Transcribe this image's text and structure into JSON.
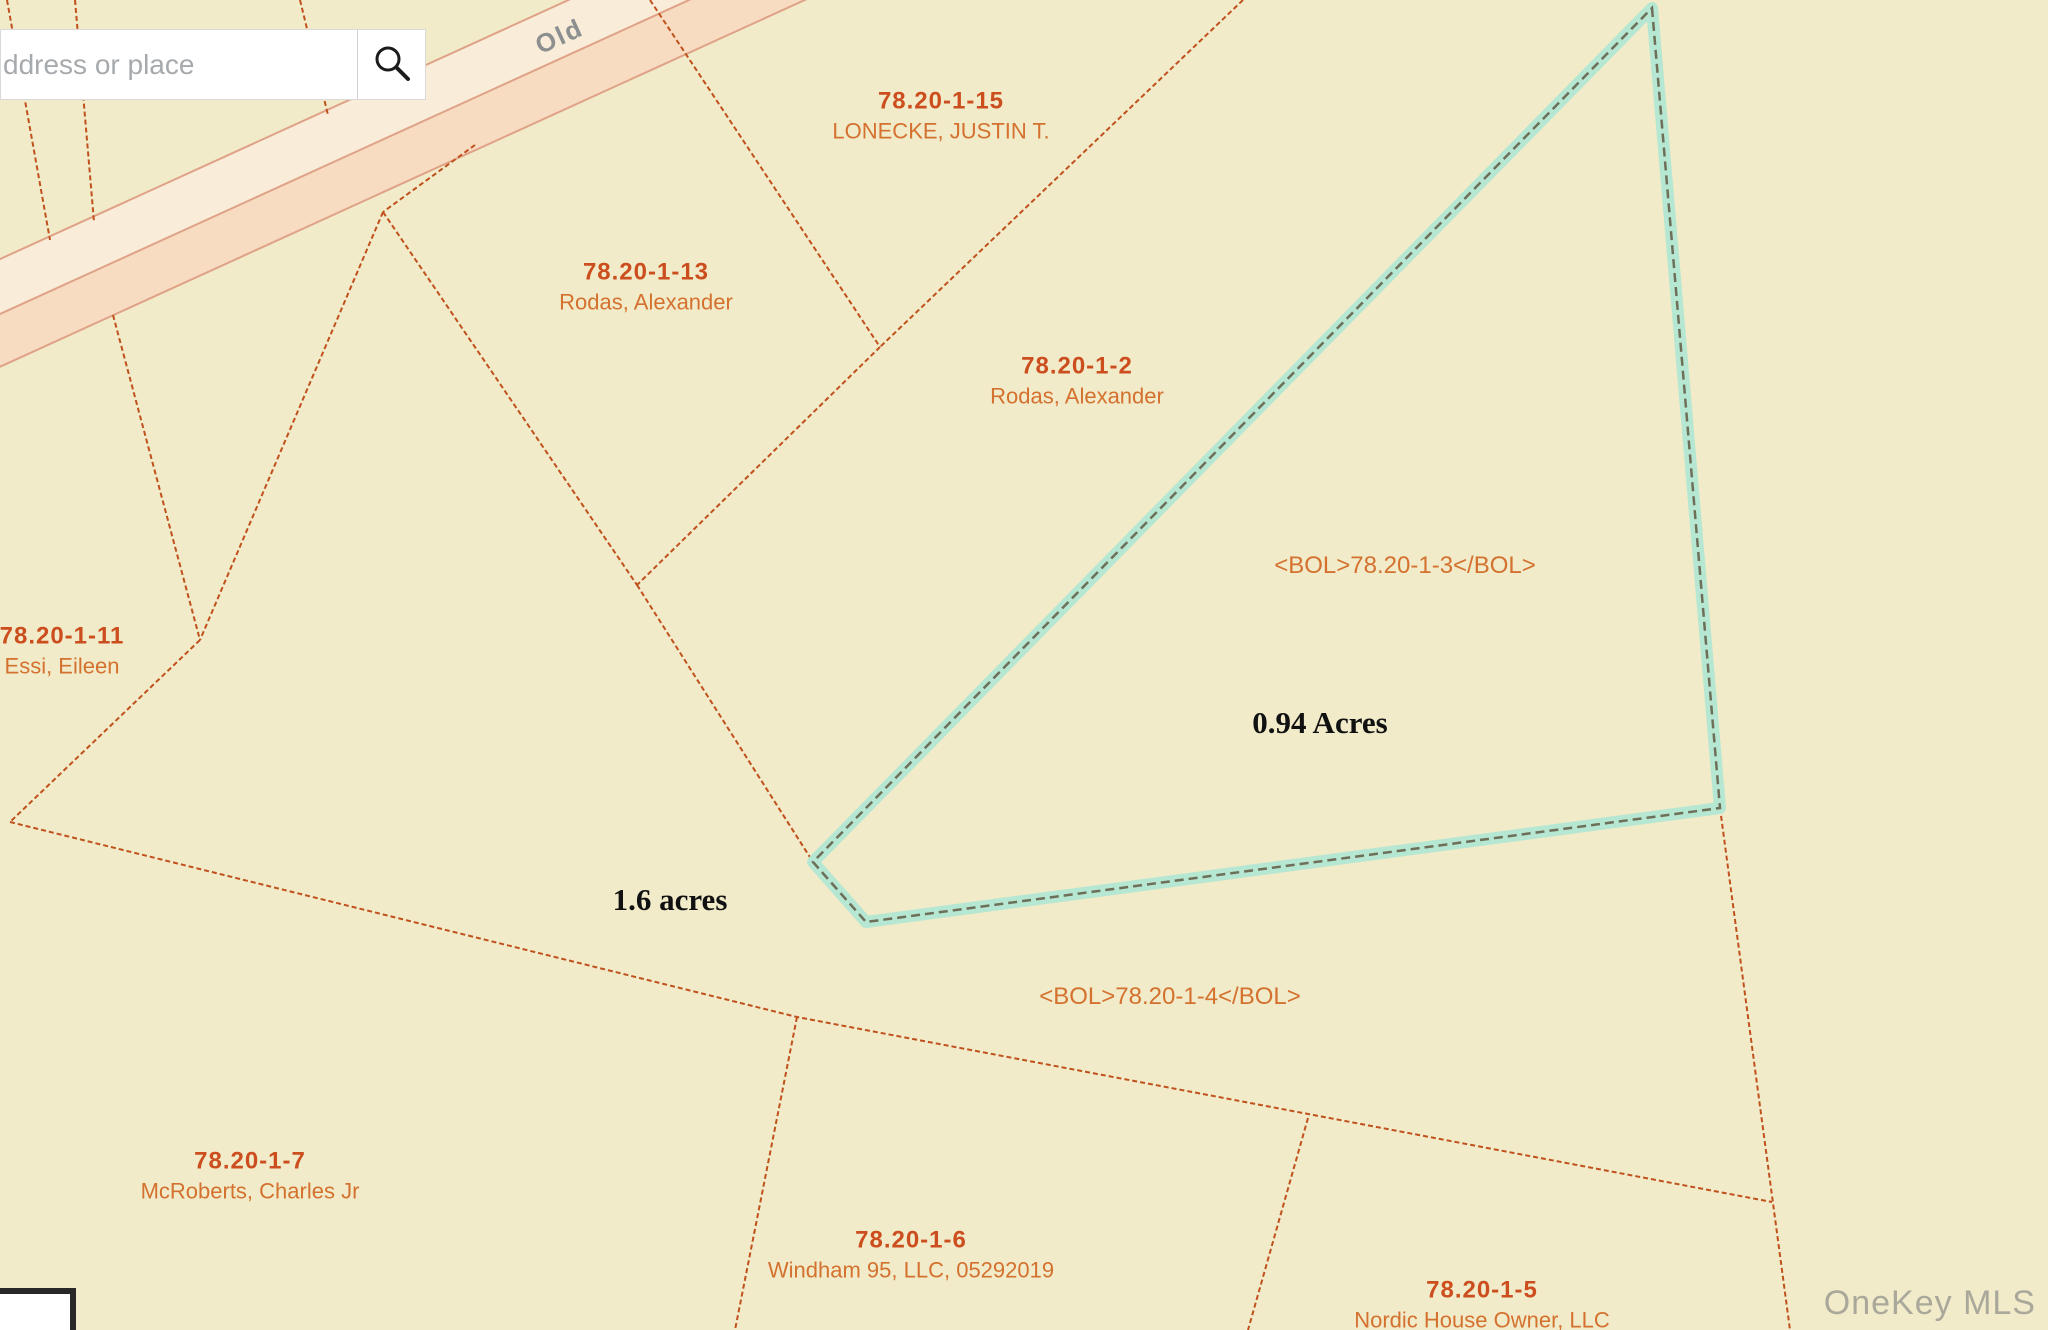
{
  "header": {
    "search": {
      "placeholder": "ddress or place",
      "icon": "magnifier"
    }
  },
  "map": {
    "background_color": "#f1ebc9",
    "boundary_line_color": "#c0511d",
    "road": {
      "label": "Old",
      "label_color": "#8c8f90",
      "angle_deg": -24.5,
      "origin": [
        0,
        325
      ],
      "strips": [
        {
          "v": -60,
          "h": 50,
          "color": "#f9ecd8"
        },
        {
          "v": -10,
          "h": 48,
          "color": "#f7dcc1"
        }
      ],
      "edge_v": [
        -60,
        -10,
        38
      ],
      "edge_color": "#dfa287",
      "label_pos": [
        604,
        -22
      ]
    },
    "boundary_lines": [
      [
        [
          7,
          0
        ],
        [
          50,
          240
        ]
      ],
      [
        [
          75,
          0
        ],
        [
          94,
          222
        ]
      ],
      [
        [
          300,
          0
        ],
        [
          328,
          115
        ]
      ],
      [
        [
          650,
          0
        ],
        [
          880,
          347
        ]
      ],
      [
        [
          1243,
          0
        ],
        [
          880,
          347
        ]
      ],
      [
        [
          880,
          347
        ],
        [
          637,
          585
        ]
      ],
      [
        [
          475,
          145
        ],
        [
          383,
          212
        ]
      ],
      [
        [
          383,
          212
        ],
        [
          637,
          585
        ]
      ],
      [
        [
          637,
          585
        ],
        [
          813,
          862
        ]
      ],
      [
        [
          383,
          212
        ],
        [
          200,
          640
        ]
      ],
      [
        [
          113,
          315
        ],
        [
          200,
          640
        ]
      ],
      [
        [
          200,
          640
        ],
        [
          10,
          822
        ]
      ],
      [
        [
          10,
          822
        ],
        [
          797,
          1017
        ],
        [
          1772,
          1202
        ]
      ],
      [
        [
          797,
          1017
        ],
        [
          735,
          1330
        ]
      ],
      [
        [
          1308,
          1118
        ],
        [
          1248,
          1330
        ]
      ],
      [
        [
          1720,
          808
        ],
        [
          1790,
          1330
        ]
      ]
    ],
    "highlighted_parcel": {
      "points": [
        [
          1652,
          8
        ],
        [
          1720,
          808
        ],
        [
          866,
          922
        ],
        [
          813,
          862
        ]
      ],
      "halo_color": "#b5e7d3",
      "line_color": "#6e6f58",
      "label": "<BOL>78.20-1-3</BOL>",
      "area": "0.94 Acres"
    },
    "parcel_labels": [
      {
        "id": "78.20-1-15",
        "owner": "LONECKE, JUSTIN T.",
        "x": 941,
        "y": 100
      },
      {
        "id": "78.20-1-13",
        "owner": "Rodas, Alexander",
        "x": 646,
        "y": 271
      },
      {
        "id": "78.20-1-2",
        "owner": "Rodas, Alexander",
        "x": 1077,
        "y": 365
      },
      {
        "id": "78.20-1-11",
        "owner": "Essi, Eileen",
        "x": 62,
        "y": 635
      },
      {
        "id": "78.20-1-7",
        "owner": "McRoberts, Charles Jr",
        "x": 250,
        "y": 1160
      },
      {
        "id": "78.20-1-6",
        "owner": "Windham 95, LLC, 05292019",
        "x": 911,
        "y": 1239
      },
      {
        "id": "78.20-1-5",
        "owner": "Nordic House Owner, LLC",
        "x": 1482,
        "y": 1289
      }
    ],
    "tag_labels": [
      {
        "text": "<BOL>78.20-1-3</BOL>",
        "x": 1405,
        "y": 566
      },
      {
        "text": "<BOL>78.20-1-4</BOL>",
        "x": 1170,
        "y": 997
      }
    ],
    "area_labels": [
      {
        "text": "0.94 Acres",
        "x": 1320,
        "y": 723
      },
      {
        "text": "1.6 acres",
        "x": 670,
        "y": 900
      }
    ],
    "label_colors": {
      "id": "#cc4e1e",
      "owner": "#d4712f",
      "area": "#111111"
    }
  },
  "overlays": {
    "watermark": "OneKey MLS"
  }
}
